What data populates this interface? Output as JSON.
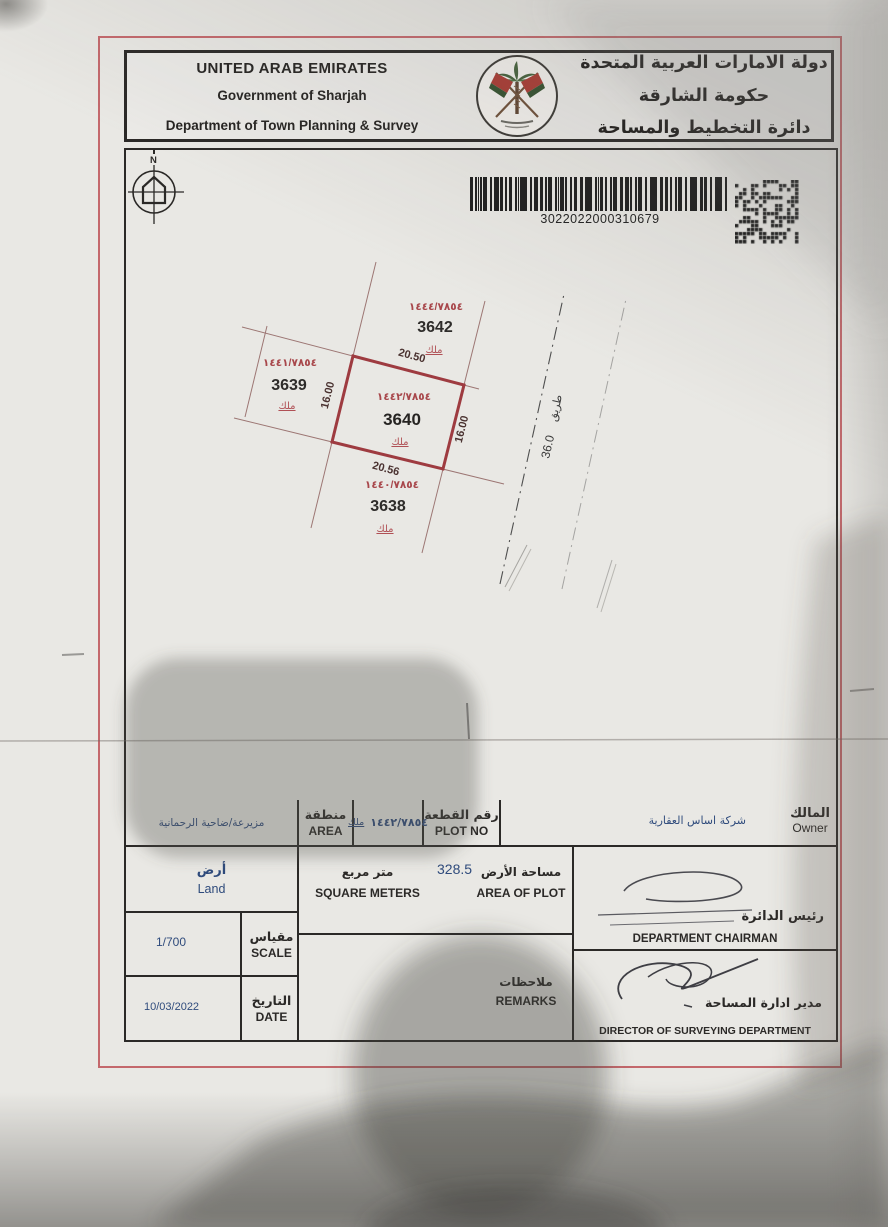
{
  "header": {
    "en": {
      "line1": "UNITED ARAB EMIRATES",
      "line2": "Government of Sharjah",
      "line3": "Department of Town Planning & Survey"
    },
    "ar": {
      "line1": "دولة الامارات العربية المتحدة",
      "line2": "حكومة الشارقة",
      "line3": "دائرة التخطيط والمساحة"
    }
  },
  "compass": {
    "label": "N"
  },
  "barcode": {
    "number": "3022022000310679"
  },
  "map": {
    "road": {
      "name": "طريق",
      "width": "36.0"
    },
    "plots": [
      {
        "id": "3642",
        "ref": "١٤٤٤/٧٨٥٤",
        "tenure": "ملك"
      },
      {
        "id": "3639",
        "ref": "١٤٤١/٧٨٥٤",
        "tenure": "ملك"
      },
      {
        "id": "3640",
        "ref": "١٤٤٢/٧٨٥٤",
        "tenure": "ملك",
        "dims": {
          "top": "20.50",
          "bottom": "20.56",
          "left": "16.00",
          "right": "16.00"
        }
      },
      {
        "id": "3638",
        "ref": "١٤٤٠/٧٨٥٤",
        "tenure": "ملك"
      }
    ]
  },
  "table": {
    "owner": {
      "label_ar": "المالك",
      "label_en": "Owner",
      "value": "شركة اساس العقارية"
    },
    "plot_no": {
      "label_ar": "رقم القطعة",
      "label_en": "PLOT NO",
      "value": "١٤٤٢/٧٨٥٤",
      "tenure": "ملك"
    },
    "area": {
      "label_ar": "منطقة",
      "label_en": "AREA",
      "value": "مزيرعة/ضاحية الرحمانية"
    },
    "land_type": {
      "value_ar": "أرض",
      "value_en": "Land"
    },
    "area_of_plot": {
      "label_ar": "مساحة الأرض",
      "label_en": "AREA OF PLOT",
      "unit_ar": "متر مربع",
      "unit_en": "SQUARE METERS",
      "value": "328.5"
    },
    "scale": {
      "label_ar": "مقياس",
      "label_en": "SCALE",
      "value": "1/700"
    },
    "date": {
      "label_ar": "التاريخ",
      "label_en": "DATE",
      "value": "10/03/2022"
    },
    "remarks": {
      "label_ar": "ملاحظات",
      "label_en": "REMARKS",
      "value": ""
    },
    "chairman": {
      "label_ar": "رئيس الدائرة",
      "label_en": "DEPARTMENT CHAIRMAN"
    },
    "director": {
      "label_ar": "مدير ادارة المساحة",
      "label_en": "DIRECTOR OF SURVEYING DEPARTMENT"
    }
  },
  "colors": {
    "frame_red": "#c4686c",
    "plot_red": "#9e3b40",
    "accent_red": "#a8474b",
    "value_blue": "#2f4b7c",
    "ink": "#2b2927"
  }
}
